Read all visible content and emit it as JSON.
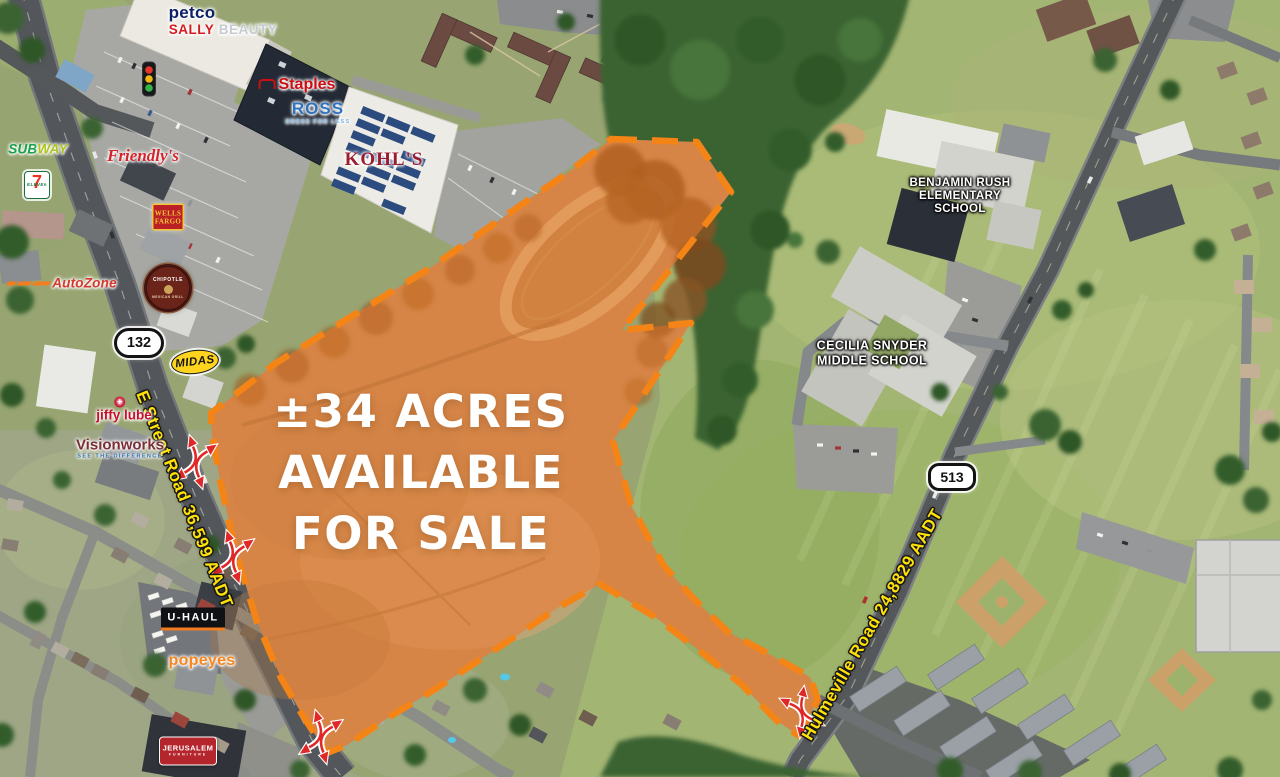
{
  "headline": {
    "line1": "±34 ACRES",
    "line2": "AVAILABLE",
    "line3": "FOR SALE"
  },
  "road_labels": {
    "e_street": "E Street Road 36,599 AADT",
    "hulmeville": "Hulmeville Road 24,8829 AADT",
    "route_132": "132",
    "route_513": "513"
  },
  "schools": {
    "benjamin_rush_line1": "BENJAMIN RUSH",
    "benjamin_rush_line2": "ELEMENTARY",
    "benjamin_rush_line3": "SCHOOL",
    "cecilia_snyder_line1": "CECILIA SNYDER",
    "cecilia_snyder_line2": "MIDDLE SCHOOL"
  },
  "retailers": {
    "petco": "petco",
    "sally_word1": "SALLY",
    "sally_word2": "BEAUTY",
    "staples": "Staples",
    "ross": "ROSS",
    "ross_tagline": "DRESS FOR LESS",
    "kohls": "KOHL'S",
    "subway_part1": "SUB",
    "subway_part2": "WAY",
    "seven_eleven_digit": "7",
    "seven_eleven_word": "ELEVEn",
    "friendlys": "Friendly's",
    "wells_fargo_line1": "WELLS",
    "wells_fargo_line2": "FARGO",
    "autozone": "AutoZone",
    "chipotle": "CHIPOTLE",
    "chipotle_tagline": "MEXICAN GRILL",
    "midas": "MIDAS",
    "jiffy_lube_word1": "jiffy",
    "jiffy_lube_word2": "lube",
    "jiffy_lube_plus": "+",
    "visionworks": "Visionworks",
    "visionworks_tagline": "SEE THE DIFFERENCE",
    "uhaul": "U-HAUL",
    "popeyes": "popeyes",
    "jerusalem": "JERUSALEM",
    "jerusalem_tagline": "FURNITURE"
  },
  "colors": {
    "parcel_orange": "#F58220",
    "parcel_fill": "#F07F28",
    "road_label_yellow": "#FFE10A",
    "arrow_red": "#E02828",
    "headline_white": "#FFFFFF"
  }
}
